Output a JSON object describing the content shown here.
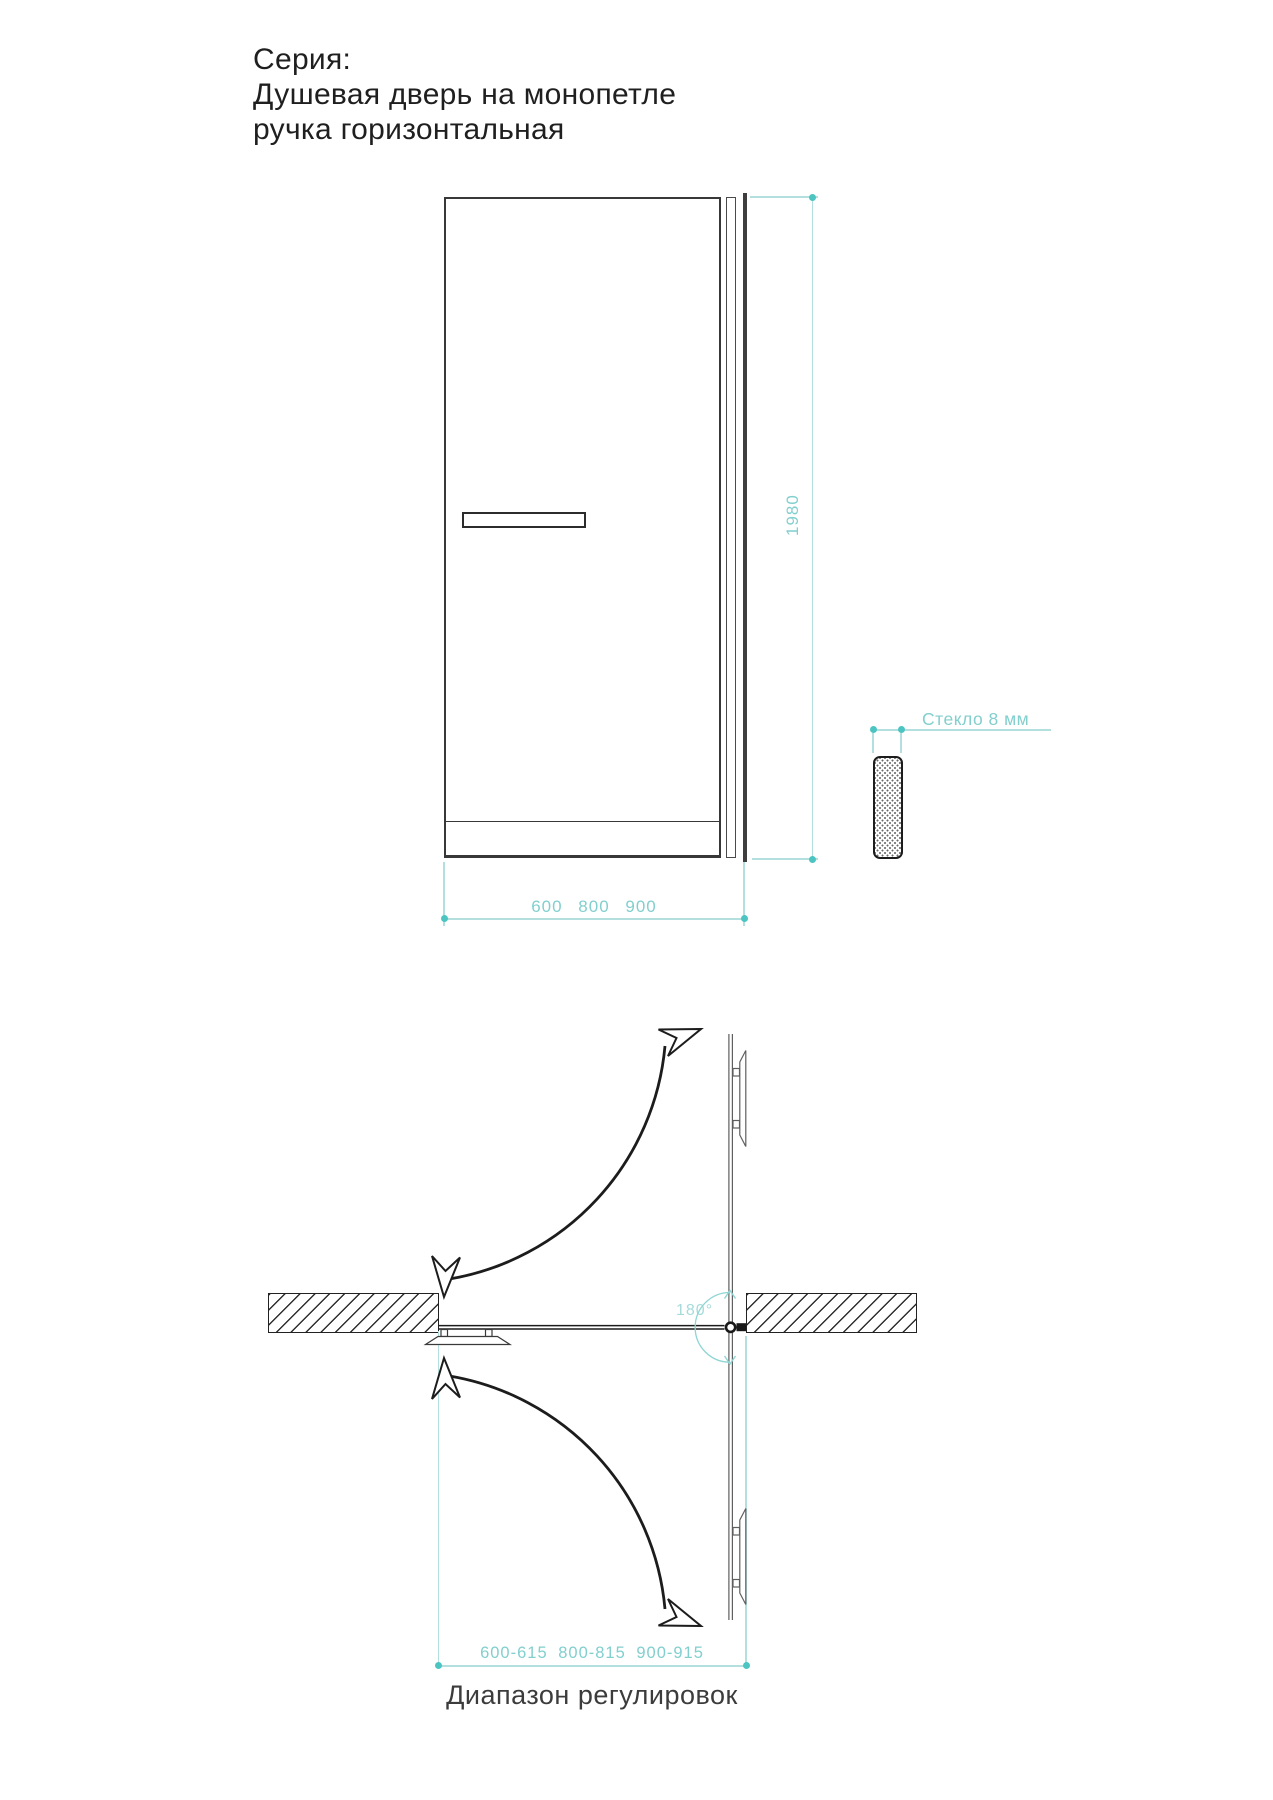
{
  "title": {
    "series_label": "Серия:",
    "product_line1": "Душевая дверь на монопетле",
    "product_line2": "ручка горизонтальная"
  },
  "front_view": {
    "height_dim": "1980",
    "width_dim": "600 800 900",
    "glass_label": "Стекло 8 мм"
  },
  "plan_view": {
    "angle_label": "180°",
    "range_dim": "600-615 800-815 900-915",
    "range_caption": "Диапазон регулировок"
  },
  "colors": {
    "accent_teal_dot": "#4cc4c1",
    "teal_line": "#b3e0df",
    "teal_text": "#82cfce",
    "angle_text": "#a6dbda",
    "ink": "#1f1f1f",
    "caption_gray": "#3c3c3c"
  }
}
